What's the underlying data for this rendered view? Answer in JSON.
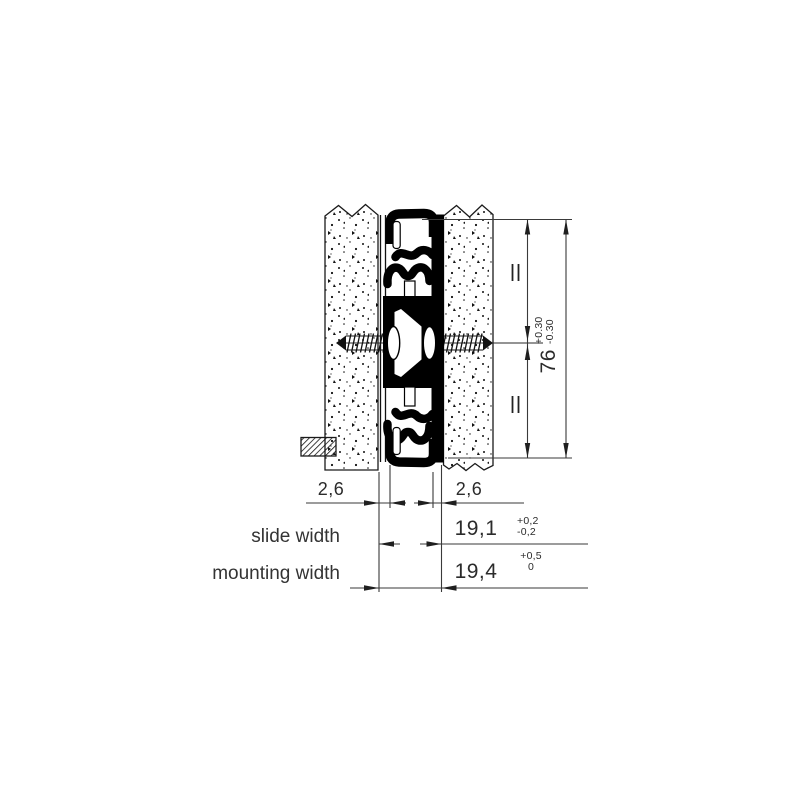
{
  "drawing": {
    "labels": {
      "slide_width": "slide width",
      "mounting_width": "mounting width"
    },
    "dims": {
      "clearance_left": "2,6",
      "clearance_right": "2,6",
      "slide_width_value": "19,1",
      "slide_width_tol_plus": "+0,2",
      "slide_width_tol_minus": "-0,2",
      "mounting_width_value": "19,4",
      "mounting_width_tol_plus": "+0,5",
      "mounting_width_tol_minus": "0",
      "height_value": "76",
      "height_tol_plus": "+0.30",
      "height_tol_minus": "-0.30"
    },
    "symbols": {
      "equality_marks": "parallel-equal-marks",
      "equality_marks_count": 2
    },
    "colors": {
      "ink": "#000000",
      "dimension_line": "#3a3a3a",
      "text": "#2b2b2b",
      "background": "#ffffff"
    }
  }
}
